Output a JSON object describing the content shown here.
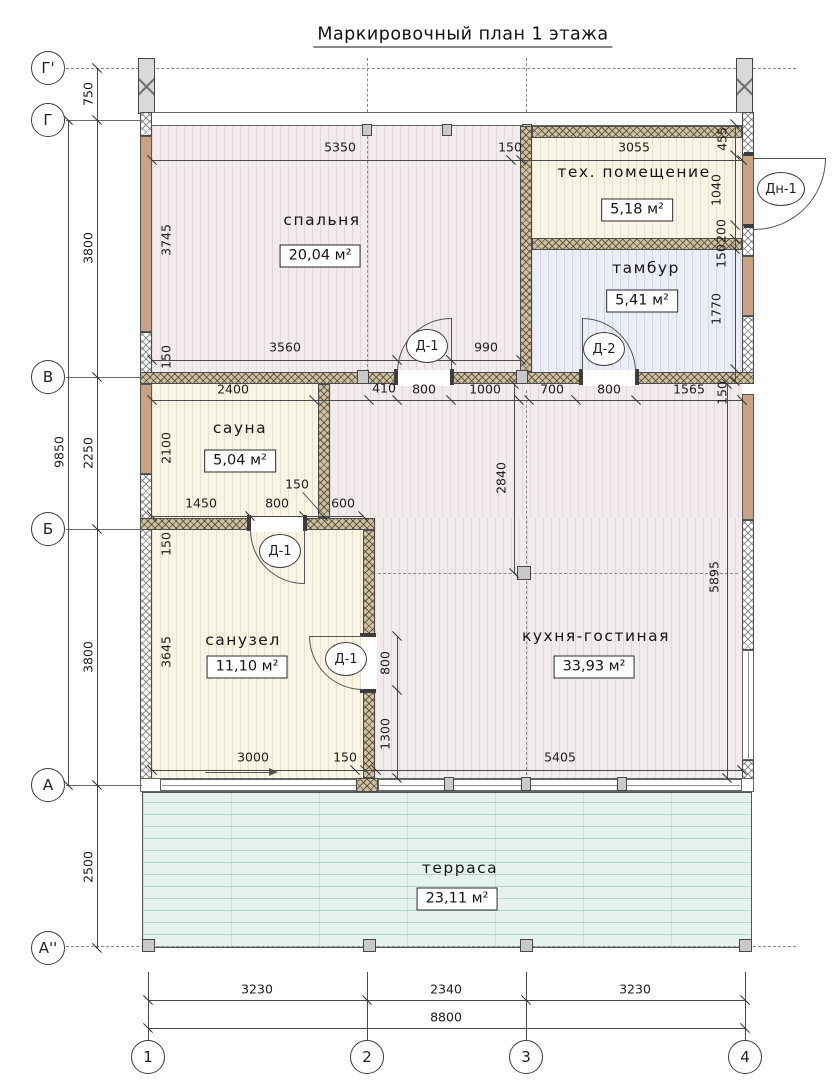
{
  "title": "Маркировочный план 1 этажа",
  "axes": {
    "rows": [
      "Г'",
      "Г",
      "В",
      "Б",
      "А",
      "А''"
    ],
    "cols": [
      "1",
      "2",
      "3",
      "4"
    ]
  },
  "rooms": {
    "bedroom": {
      "name": "спальня",
      "area": "20,04 м²"
    },
    "tech": {
      "name": "тех. помещение",
      "area": "5,18 м²"
    },
    "tambour": {
      "name": "тамбур",
      "area": "5,41 м²"
    },
    "sauna": {
      "name": "сауна",
      "area": "5,04 м²"
    },
    "bathroom": {
      "name": "санузел",
      "area": "11,10 м²"
    },
    "kitchen": {
      "name": "кухня-гостиная",
      "area": "33,93 м²"
    },
    "terrace": {
      "name": "терраса",
      "area": "23,11 м²"
    }
  },
  "doors": {
    "d1": "Д-1",
    "d2": "Д-2",
    "dn1": "Дн-1"
  },
  "dims": {
    "left_overall": "9850",
    "left": [
      "750",
      "3800",
      "2250",
      "3800",
      "2500"
    ],
    "bottom": [
      "3230",
      "2340",
      "3230"
    ],
    "bottom_overall": "8800",
    "top": [
      "5350",
      "150",
      "3055"
    ],
    "right_top": [
      "455",
      "1040",
      "200",
      "150",
      "1770"
    ],
    "bedroom_left": [
      "3745",
      "150"
    ],
    "above_v": [
      "3560",
      "990"
    ],
    "below_v": [
      "2400",
      "410",
      "800",
      "1000",
      "700",
      "800",
      "1565",
      "150"
    ],
    "sauna_v": [
      "2100"
    ],
    "above_b": [
      "1450",
      "800",
      "150",
      "600"
    ],
    "below_b": [
      "150"
    ],
    "bathroom_v": [
      "3645"
    ],
    "bathroom_b": [
      "3000",
      "150"
    ],
    "bath_door": [
      "800",
      "1300"
    ],
    "kitchen": [
      "2840",
      "5895",
      "5405"
    ]
  }
}
